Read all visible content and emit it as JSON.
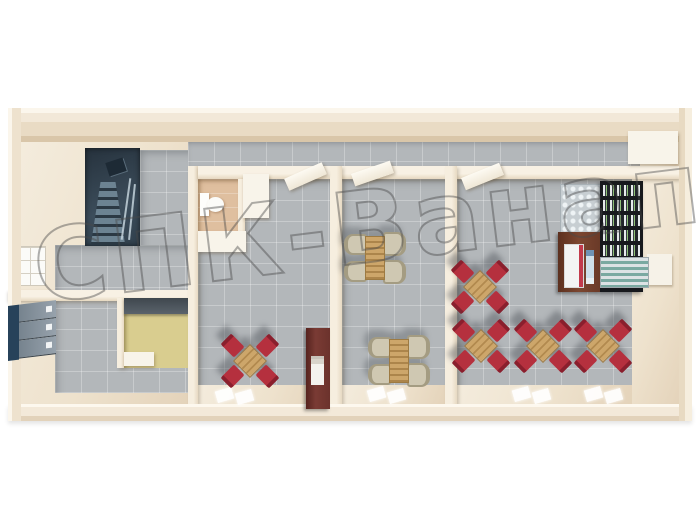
{
  "scene": {
    "type": "3d-floorplan-render",
    "description": "Top-down 3D render of a single-storey modular canteen building with staircase, washroom block, two small dining rooms and a large dining hall with serving shelves"
  },
  "watermark": {
    "text": "СПК-Ванап",
    "stroke_color": "#484848"
  },
  "palette": {
    "background": "#ffffff",
    "wall_cream": "#f2e8d8",
    "wall_shadow": "#d9c6a9",
    "floor_tile_grey": "#b3b7ba",
    "floor_beige": "#eee2cd",
    "floor_peach": "#dfbf9f",
    "floor_yellow": "#d9cd8f",
    "stairs_dark": "#31414e",
    "stairs_step": "#6c8392",
    "locker_navy": "#27425a",
    "locker_door": "#8d99a4",
    "chair_red": "#b5303e",
    "chair_red_back": "#8a1f2d",
    "table_wood": "#cda66a",
    "chair_beige": "#cfc8b2",
    "cabinet_burgundy": "#6b322c",
    "bottle_rack_dark": "#17191d",
    "shelf_brown": "#7c4630",
    "cooler_teal": "#7aa9a1",
    "mat_white": "#ffffff"
  },
  "furniture": {
    "red_dining_sets": [
      {
        "x": 250,
        "y": 361
      },
      {
        "x": 480,
        "y": 287
      },
      {
        "x": 481,
        "y": 346
      },
      {
        "x": 543,
        "y": 346
      },
      {
        "x": 603,
        "y": 346
      }
    ],
    "beige_dining_sets": [
      {
        "x": 375,
        "y": 258
      },
      {
        "x": 399,
        "y": 361
      }
    ],
    "floor_mats": [
      {
        "x": 224,
        "y": 395
      },
      {
        "x": 244,
        "y": 397
      },
      {
        "x": 376,
        "y": 394
      },
      {
        "x": 396,
        "y": 396
      },
      {
        "x": 521,
        "y": 394
      },
      {
        "x": 541,
        "y": 396
      },
      {
        "x": 593,
        "y": 394
      },
      {
        "x": 613,
        "y": 396
      }
    ],
    "locker_doors": 3,
    "bottle_rack_rows": 5
  }
}
